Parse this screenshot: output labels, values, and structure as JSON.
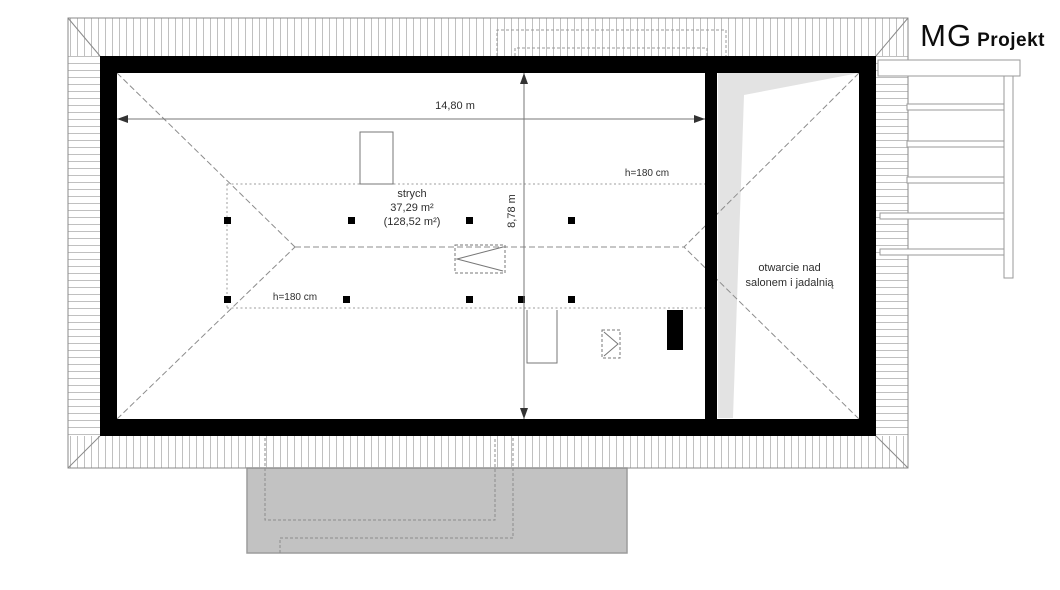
{
  "brand": {
    "mg": "MG",
    "projekt": "Projekt"
  },
  "plan": {
    "dim_width": "14,80 m",
    "dim_height": "8,78 m",
    "room_name": "strych",
    "room_area": "37,29 m²",
    "room_area_total": "(128,52 m²)",
    "h_line_top": "h=180 cm",
    "h_line_bottom": "h=180 cm",
    "opening_line1": "otwarcie nad",
    "opening_line2": "salonem i jadalnią"
  },
  "colors": {
    "wall": "#000000",
    "terrace_fill": "#c2c2c2",
    "opening_shade": "#e3e3e3",
    "hatch_line": "#c0c0c0",
    "roof_dash": "#8c8c8c"
  }
}
